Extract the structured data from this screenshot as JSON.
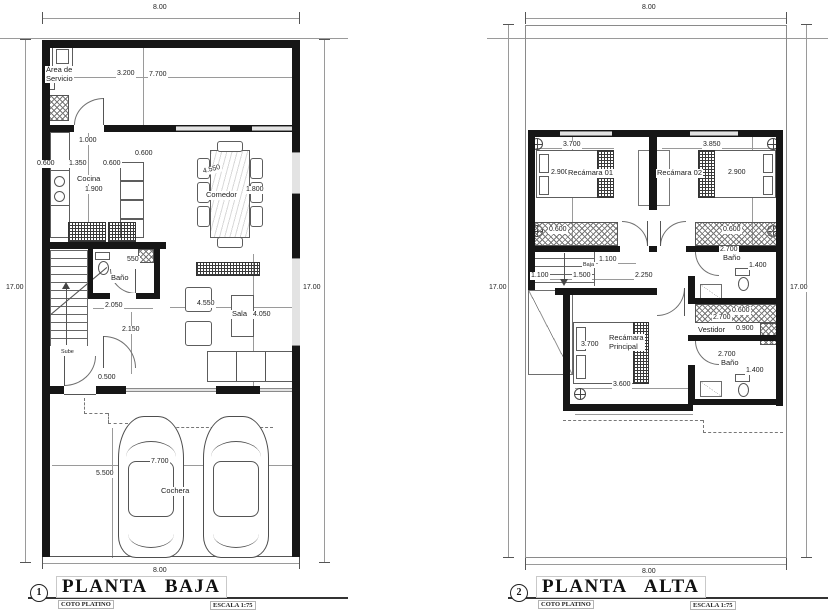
{
  "pb": {
    "number": "1",
    "title": "PLANTA BAJA",
    "firm": "COTO PLATINO",
    "scale": "ESCALA 1:75",
    "dim_top": "8.00",
    "dim_bottom": "8.00",
    "dim_left": "17.00",
    "dim_right": "17.00",
    "rooms": {
      "servicio": "Área de\nServicio",
      "cocina": "Cocina",
      "comedor": "Comedor",
      "bano": "Baño",
      "sala": "Sala",
      "sube": "Sube",
      "cochera": "Cochera"
    },
    "dims": {
      "d3200": "3.200",
      "d7700": "7.700",
      "d1000": "1.000",
      "d0600a": "0.600",
      "d1350": "1.350",
      "d0600b": "0.600",
      "d0600c": "0.600",
      "d1900": "1.900",
      "d4550": "4.550",
      "d1800": "1.800",
      "d550": "550",
      "d2050": "2.050",
      "d2150": "2.150",
      "d0500": "0.500",
      "d4550b": "4.550",
      "d4050": "4.050",
      "d5500": "5.500",
      "d7700b": "7.700"
    }
  },
  "pa": {
    "number": "2",
    "title": "PLANTA ALTA",
    "firm": "COTO PLATINO",
    "scale": "ESCALA 1:75",
    "dim_top": "8.00",
    "dim_bottom": "8.00",
    "dim_left": "17.00",
    "dim_right": "17.00",
    "rooms": {
      "rec1": "Recámara 01",
      "rec2": "Recámara 02",
      "baja": "Baja",
      "bano1": "Baño",
      "vestidor": "Vestidor",
      "recp": "Recámara\nPrincipal",
      "bano2": "Baño"
    },
    "dims": {
      "d3700": "3.700",
      "d3850": "3.850",
      "d2900a": "2.900",
      "d2900b": "2.900",
      "d0600a": "0.600",
      "d0600b": "0.600",
      "d1100a": "1.100",
      "d1100b": "1.100",
      "d1500": "1.500",
      "d2250": "2.250",
      "d2700a": "2.700",
      "d1400a": "1.400",
      "d0600c": "0.600",
      "d2700b": "2.700",
      "d0900": "0.900",
      "d3700b": "3.700",
      "d3600": "3.600",
      "d2700c": "2.700",
      "d1400b": "1.400"
    }
  }
}
